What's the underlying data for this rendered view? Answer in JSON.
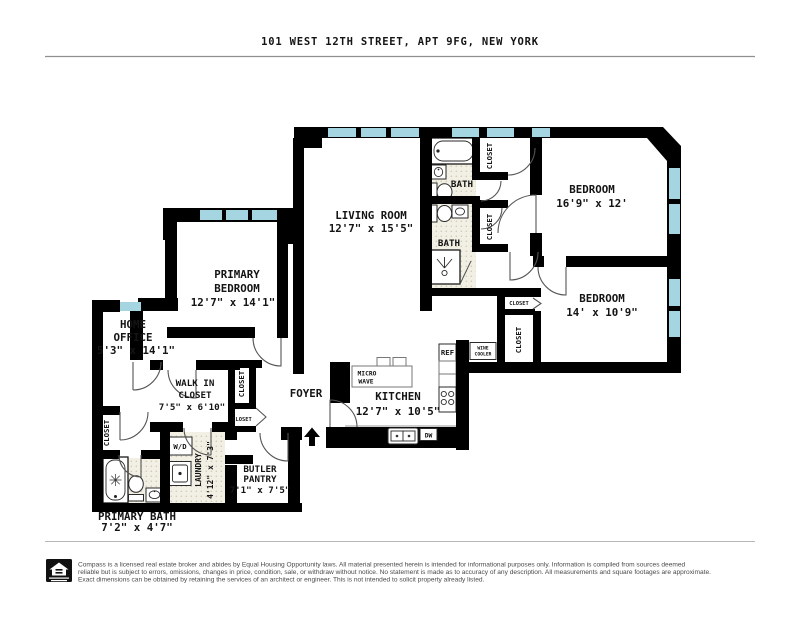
{
  "title": "101 WEST 12TH STREET, APT 9FG, NEW YORK",
  "rooms": {
    "living_room": {
      "name": "LIVING ROOM",
      "dims": "12'7\" x 15'5\""
    },
    "bedroom_top": {
      "name": "BEDROOM",
      "dims": "16'9\" x 12'"
    },
    "bedroom_right": {
      "name": "BEDROOM",
      "dims": "14' x 10'9\""
    },
    "primary_bedroom": {
      "line1": "PRIMARY",
      "line2": "BEDROOM",
      "dims": "12'7\" x 14'1\""
    },
    "home_office": {
      "line1": "HOME",
      "line2": "OFFICE",
      "dims": "5'3\" x 14'1\""
    },
    "walk_in_closet": {
      "line1": "WALK IN",
      "line2": "CLOSET",
      "dims": "7'5\" x 6'10\""
    },
    "kitchen": {
      "name": "KITCHEN",
      "dims": "12'7\" x 10'5\""
    },
    "foyer": {
      "name": "FOYER"
    },
    "butler_pantry": {
      "line1": "BUTLER",
      "line2": "PANTRY",
      "dims": "7'1\" x 7'5\""
    },
    "laundry": {
      "name": "LAUNDRY",
      "dims": "4'12\" x 7'3\""
    },
    "primary_bath": {
      "name": "PRIMARY BATH",
      "dims": "7'2\" x 4'7\""
    },
    "bath_upper": {
      "name": "BATH"
    },
    "bath_lower": {
      "name": "BATH"
    },
    "closet_label": "CLOSET"
  },
  "appliances": {
    "ref": "REF",
    "dw": "DW",
    "wd": "W/D",
    "micro_line1": "MICRO",
    "micro_line2": "WAVE",
    "wine_line1": "WINE",
    "wine_line2": "COOLER"
  },
  "footer": {
    "line1": "Compass is a licensed real estate broker and abides by Equal Housing Opportunity laws. All material presented herein is intended for informational purposes only. Information is compiled from sources deemed",
    "line2": "reliable but is subject to errors, omissions, changes in price, condition, sale, or withdraw without notice. No statement is made as to accuracy of any description. All measurements and square footages are approximate.",
    "line3": "Exact dimensions can be obtained by retaining the services of an architect or engineer. This is not intended to solicit property already listed."
  },
  "colors": {
    "wall": "#000000",
    "window": "#a5d5e0",
    "bath_floor": "#f2efe4",
    "floor_dot": "#cfc8b2"
  }
}
